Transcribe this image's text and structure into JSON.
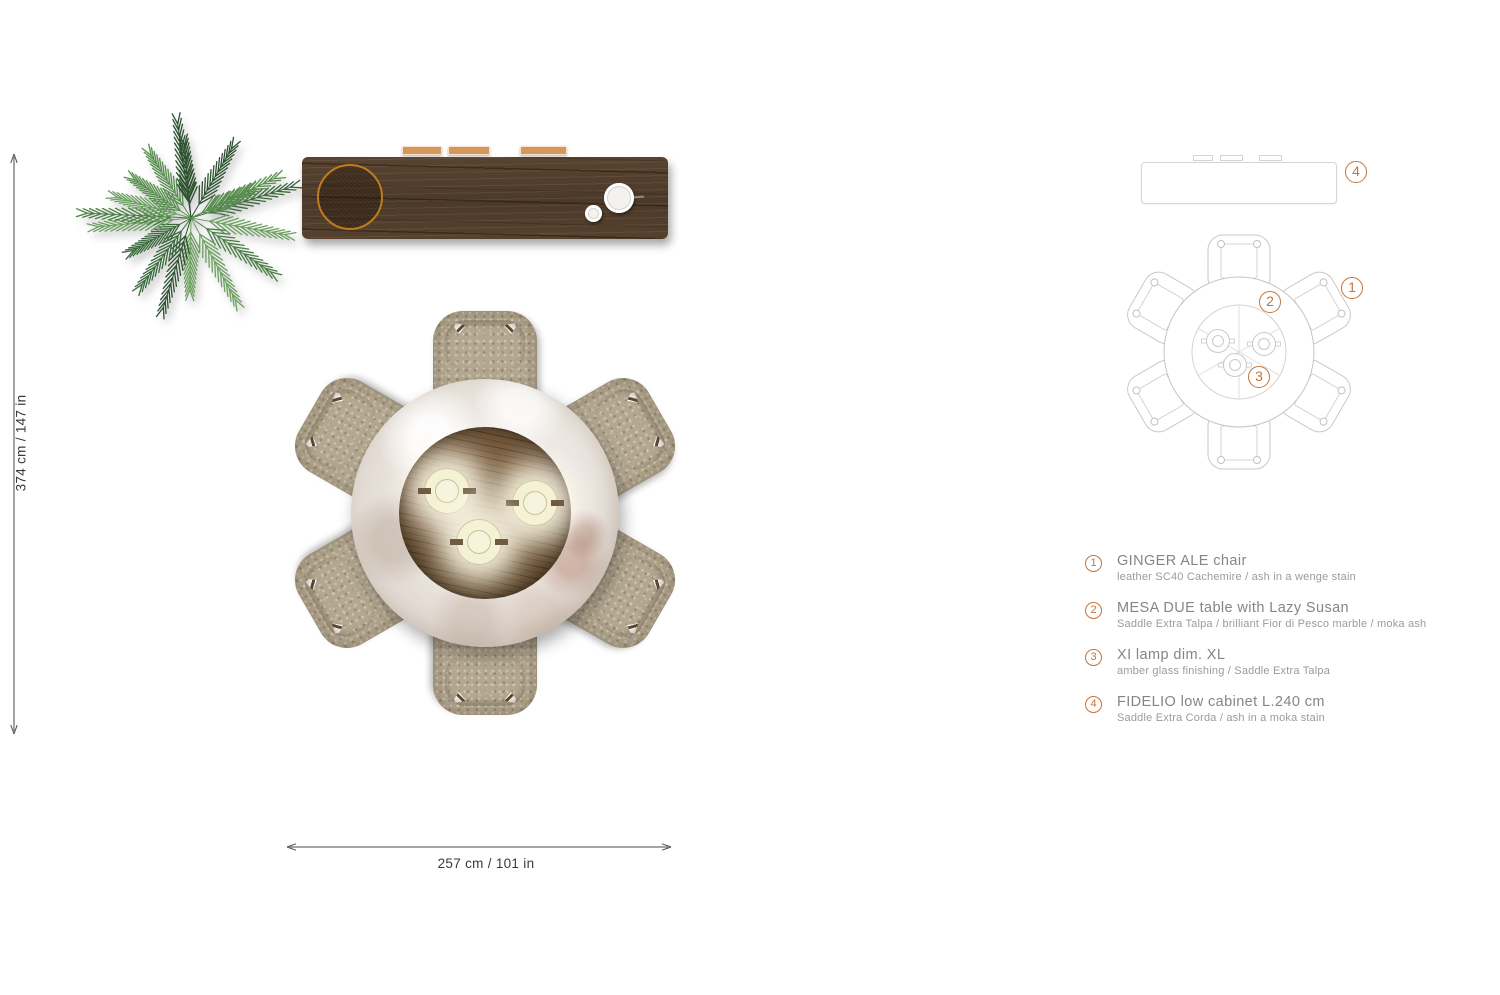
{
  "dimensions": {
    "vertical_label": "374 cm / 147 in",
    "horizontal_label": "257 cm / 101 in"
  },
  "legend": {
    "items": [
      {
        "number": "1",
        "title": "GINGER ALE chair",
        "subtitle": "leather SC40 Cachemire / ash in a wenge stain"
      },
      {
        "number": "2",
        "title": "MESA DUE table with Lazy Susan",
        "subtitle": "Saddle Extra Talpa / brilliant Fior di Pesco marble / moka ash"
      },
      {
        "number": "3",
        "title": "XI lamp dim. XL",
        "subtitle": "amber glass finishing / Saddle Extra Talpa"
      },
      {
        "number": "4",
        "title": "FIDELIO low cabinet L.240 cm",
        "subtitle": "Saddle Extra Corda / ash in a moka stain"
      }
    ]
  },
  "colors": {
    "accent_orange": "#c4743a",
    "cabinet_ring_amber": "#bd7d1d",
    "cabinet_wood": "#4e3a2b",
    "table_wood": "#60492f",
    "marble": "#e4ddd6",
    "leather_taupe": "#b3a78f",
    "lamp_cream": "#f5f1d4",
    "tray_tan": "#d6985a",
    "plant_green": "#497e44",
    "schematic_line": "#c9c9c9",
    "legend_text_gray": "#858585",
    "dimension_text": "#3a3a3a"
  }
}
